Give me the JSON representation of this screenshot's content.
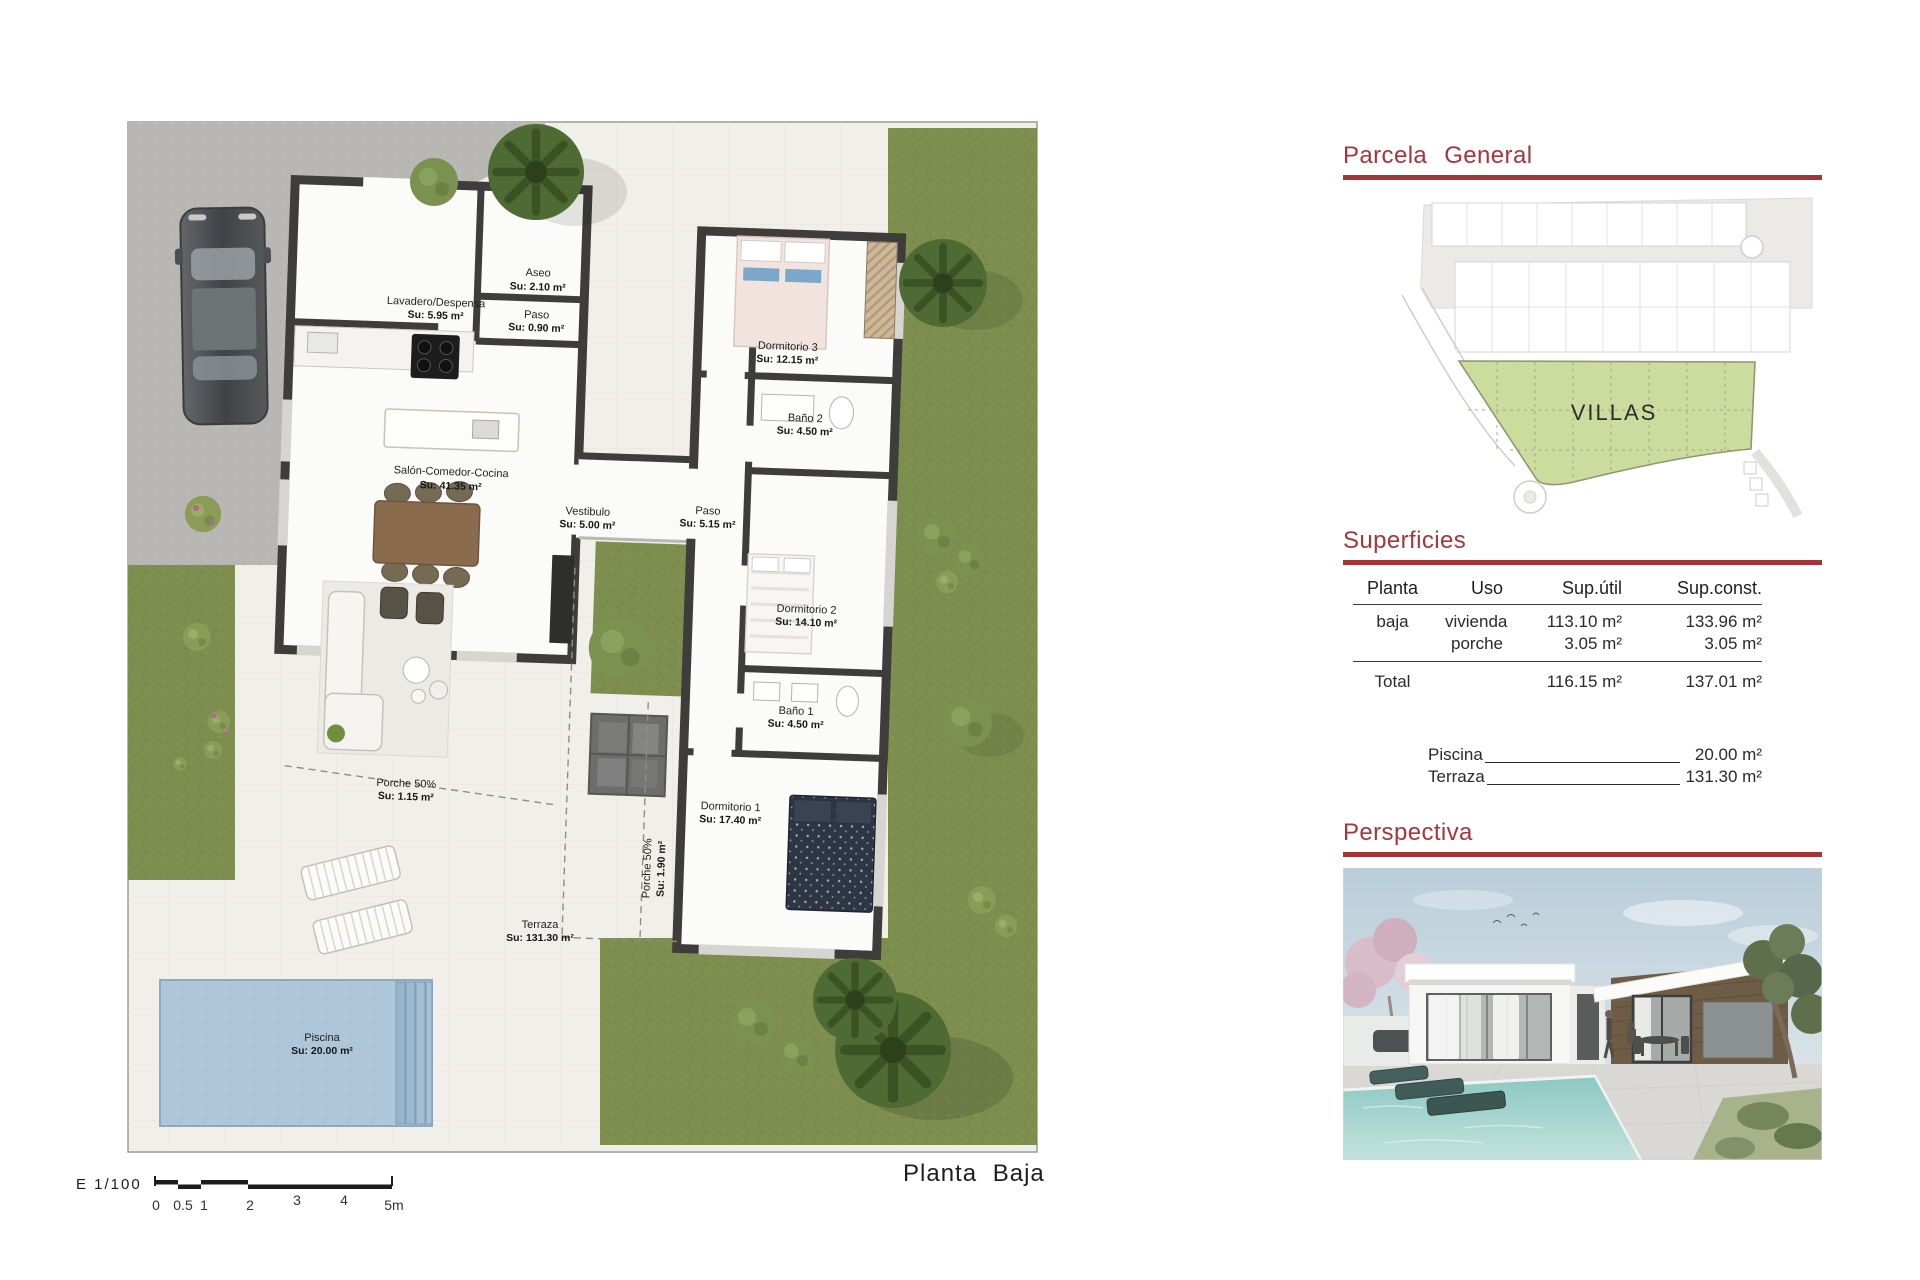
{
  "plan": {
    "title": "Planta Baja",
    "scale": {
      "label": "E 1/100",
      "ticks": [
        "0",
        "0.5",
        "1",
        "2",
        "3",
        "4",
        "5m"
      ]
    },
    "rooms": [
      {
        "name": "Lavadero/Despensa",
        "area": "Su: 5.95 m²"
      },
      {
        "name": "Aseo",
        "area": "Su: 2.10 m²"
      },
      {
        "name": "Paso",
        "area": "Su: 0.90 m²"
      },
      {
        "name": "Salón-Comedor-Cocina",
        "area": "Su: 41.35 m²"
      },
      {
        "name": "Vestibulo",
        "area": "Su: 5.00 m²"
      },
      {
        "name": "Paso",
        "area": "Su: 5.15 m²"
      },
      {
        "name": "Dormitorio 3",
        "area": "Su: 12.15 m²"
      },
      {
        "name": "Baño 2",
        "area": "Su: 4.50 m²"
      },
      {
        "name": "Dormitorio 2",
        "area": "Su: 14.10 m²"
      },
      {
        "name": "Baño 1",
        "area": "Su: 4.50 m²"
      },
      {
        "name": "Dormitorio 1",
        "area": "Su: 17.40 m²"
      },
      {
        "name": "Porche 50%",
        "area": "Su: 1.15 m²"
      },
      {
        "name": "Porche 50%",
        "area": "Su: 1.90 m²"
      },
      {
        "name": "Terraza",
        "area": "Su: 131.30 m²"
      },
      {
        "name": "Piscina",
        "area": "Su: 20.00 m²"
      }
    ]
  },
  "parcela": {
    "heading": "Parcela General",
    "villas_label": "VILLAS"
  },
  "superficies": {
    "heading": "Superficies",
    "columns": [
      "Planta",
      "Uso",
      "Sup.útil",
      "Sup.const."
    ],
    "rows": [
      {
        "planta": "baja",
        "uso": "vivienda",
        "util": "113.10 m²",
        "const": "133.96 m²"
      },
      {
        "planta": "",
        "uso": "porche",
        "util": "3.05 m²",
        "const": "3.05 m²"
      }
    ],
    "total": {
      "label": "Total",
      "util": "116.15 m²",
      "const": "137.01 m²"
    },
    "extras": [
      {
        "label": "Piscina",
        "value": "20.00 m²"
      },
      {
        "label": "Terraza",
        "value": "131.30 m²"
      }
    ]
  },
  "perspectiva": {
    "heading": "Perspectiva"
  },
  "colors": {
    "accent_red": "#a9343a",
    "grass": "#7d8e4e",
    "villas_green": "#ccdb9e",
    "pool_blue": "#aec6da"
  }
}
